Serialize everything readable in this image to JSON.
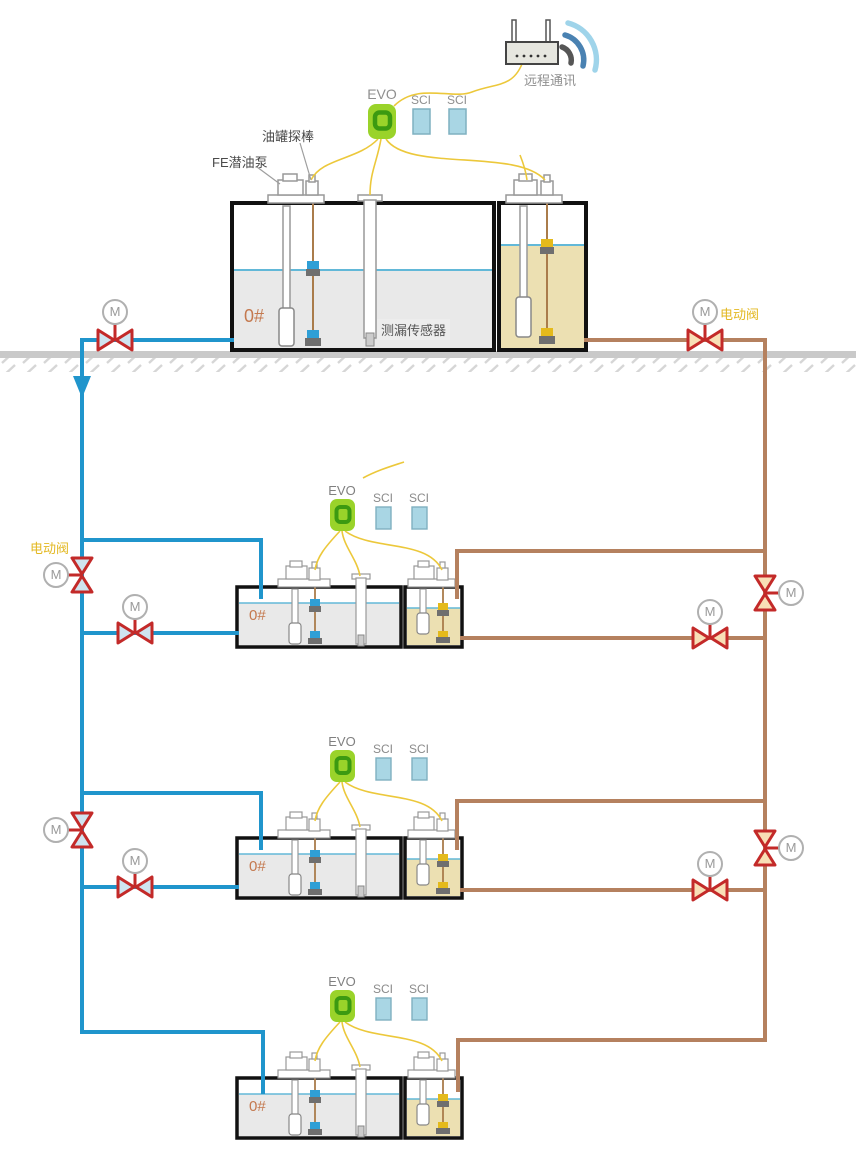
{
  "network": {
    "label": "远程通讯"
  },
  "surface_station": {
    "evo_label": "EVO",
    "sci_labels": [
      "SCI",
      "SCI"
    ],
    "fuel_grade": "0#",
    "probe_label": "油罐探棒",
    "pump_label": "FE潜油泵",
    "leak_sensor_label": "测漏传感器"
  },
  "underground_stations": [
    {
      "evo_label": "EVO",
      "sci_labels": [
        "SCI",
        "SCI"
      ],
      "fuel_grade": "0#"
    },
    {
      "evo_label": "EVO",
      "sci_labels": [
        "SCI",
        "SCI"
      ],
      "fuel_grade": "0#"
    },
    {
      "evo_label": "EVO",
      "sci_labels": [
        "SCI",
        "SCI"
      ],
      "fuel_grade": "0#"
    }
  ],
  "valves": {
    "top_left": {
      "motor": "M"
    },
    "top_right": {
      "motor": "M",
      "label": "电动阀"
    },
    "left_main": {
      "label": "电动阀",
      "motors": [
        "M",
        "M"
      ]
    },
    "left_branches": {
      "motors": [
        "M",
        "M"
      ]
    },
    "right_main": {
      "motors": [
        "M",
        "M"
      ]
    },
    "right_branches": {
      "motors": [
        "M",
        "M"
      ]
    }
  },
  "colors": {
    "supply_pipe_blue": "#2095cc",
    "return_pipe_brown": "#b5815f",
    "signal_wire_yellow": "#ecc83b",
    "valve_red": "#c32a29",
    "evo_green": "#9ad32a",
    "sci_blue": "#a9d6e4",
    "diesel_liquid_gray": "#e9e9e9",
    "gasoline_liquid_tan": "#ece0b2",
    "ground_gray": "#c9c9c9"
  }
}
